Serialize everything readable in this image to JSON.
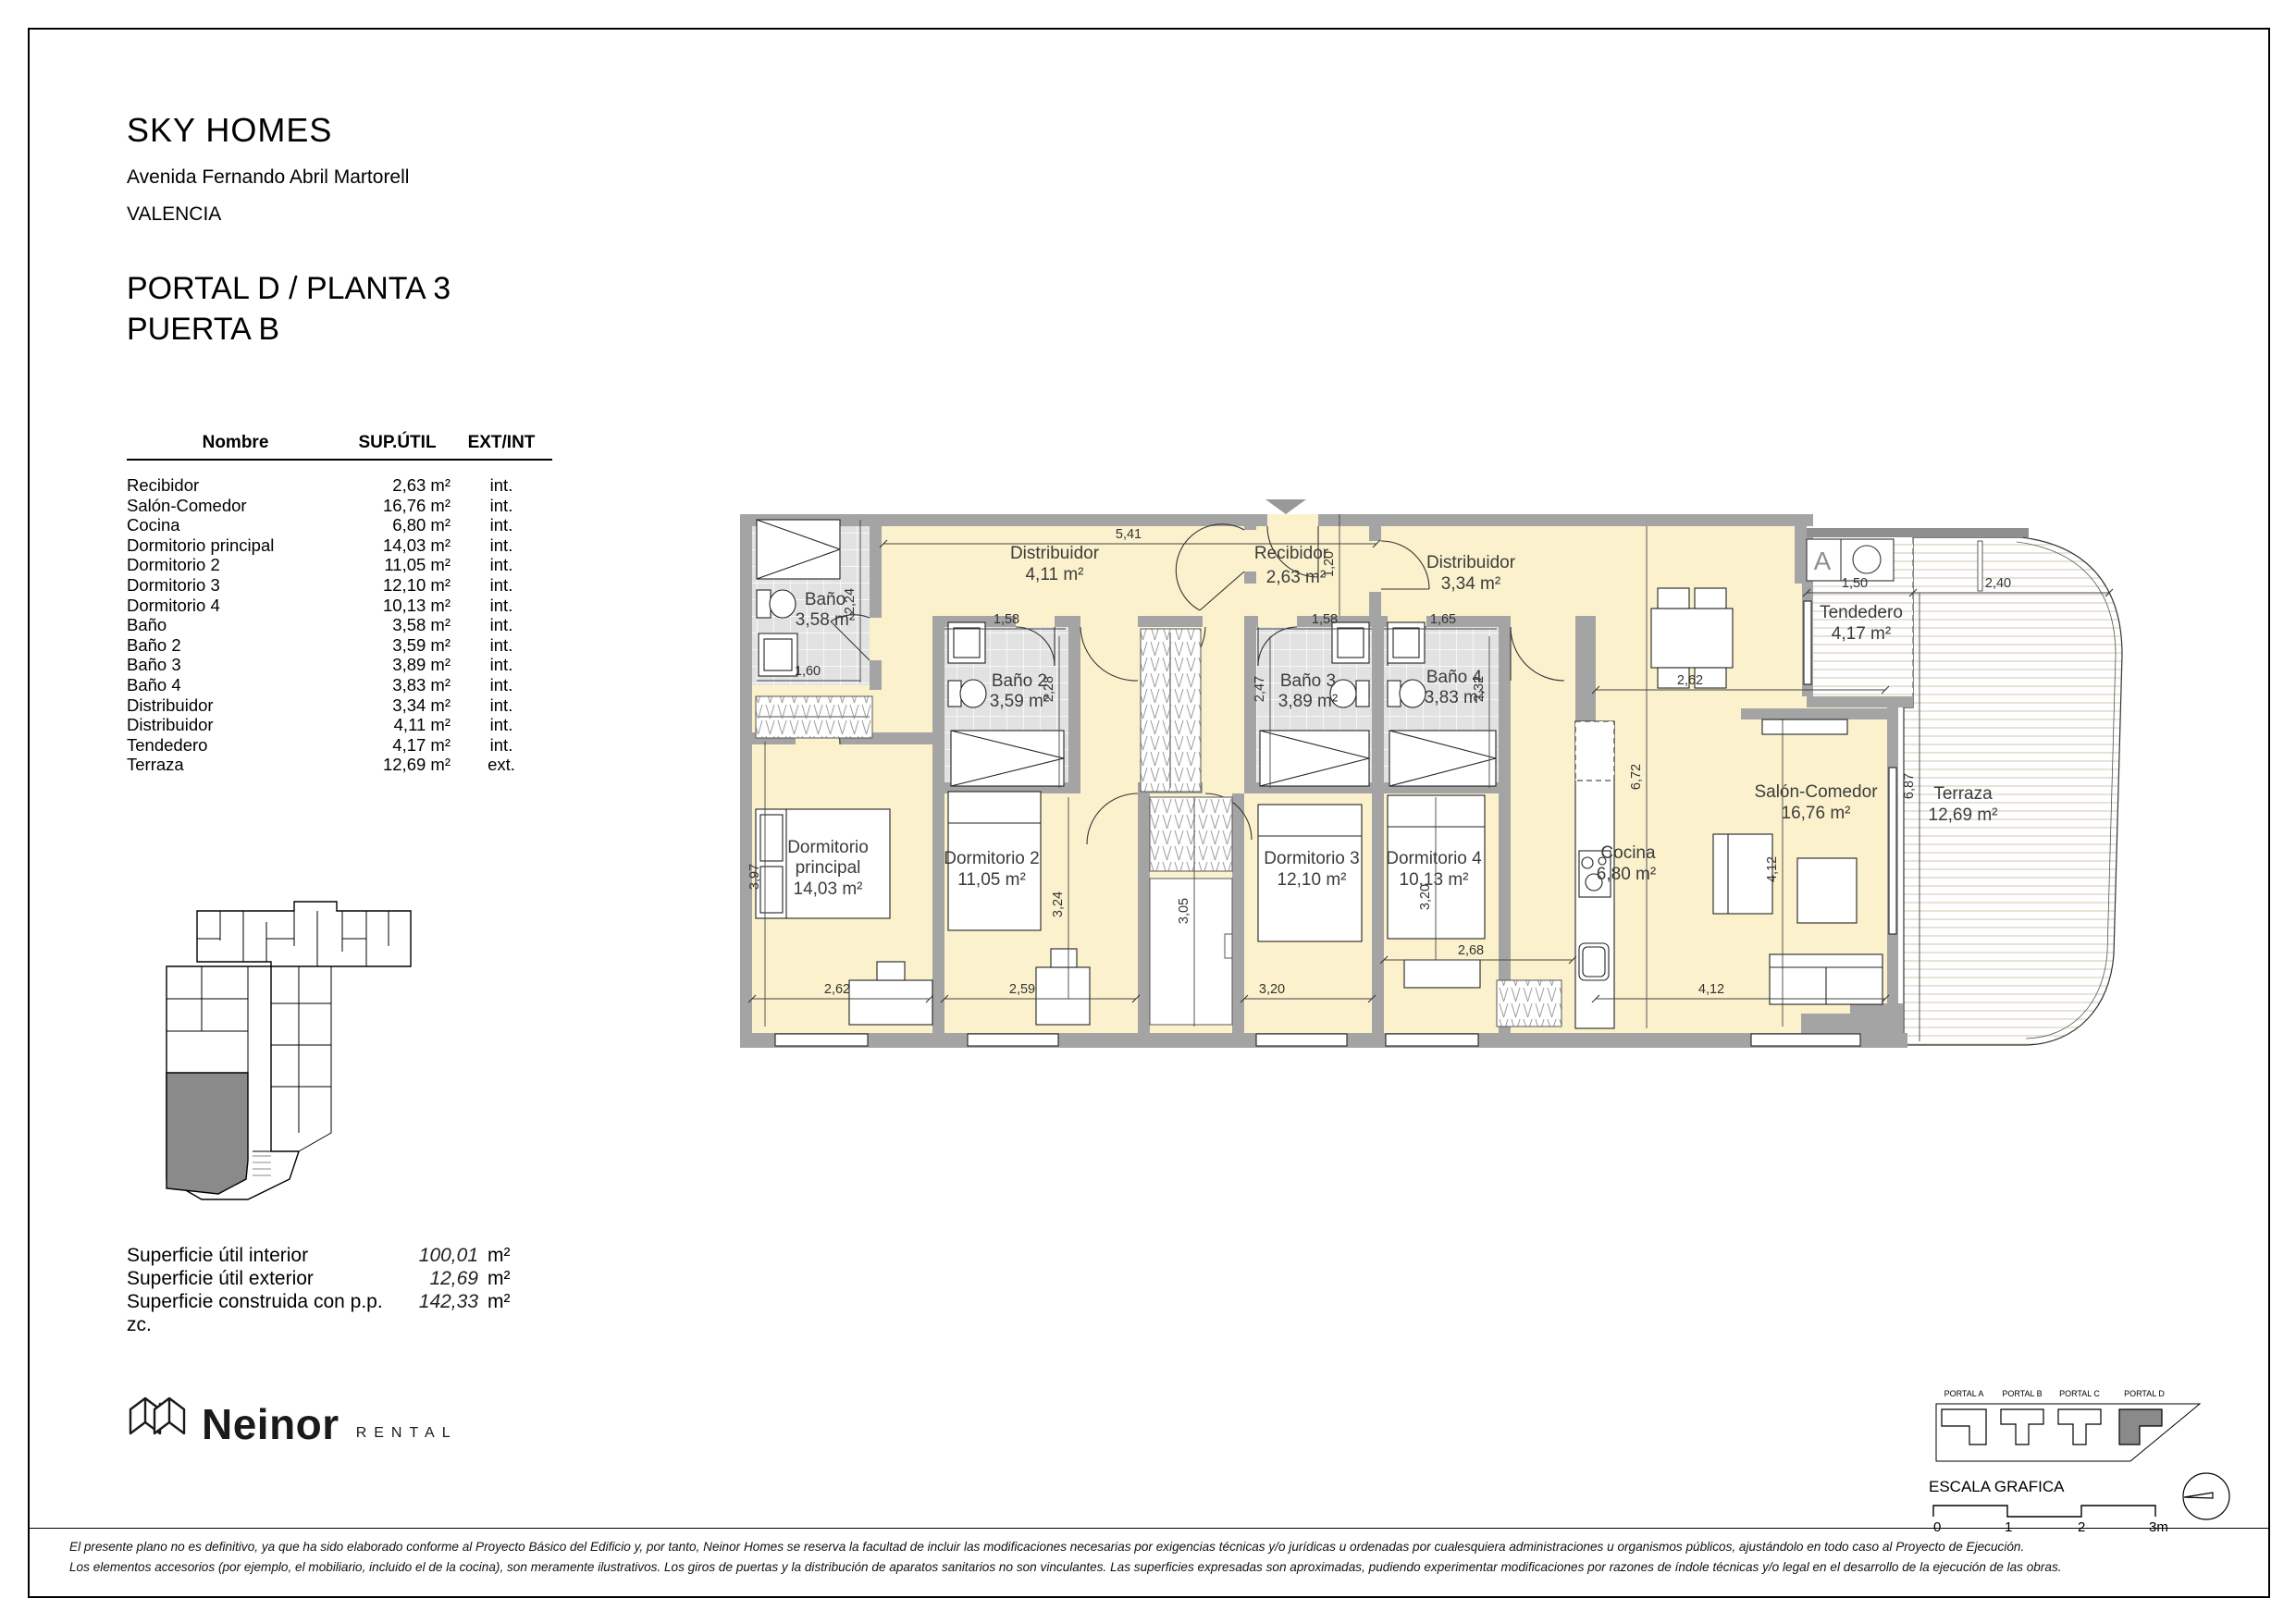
{
  "document": {
    "title": "SKY HOMES",
    "address": "Avenida Fernando Abril Martorell",
    "city": "VALENCIA",
    "unit_line1": "PORTAL D / PLANTA 3",
    "unit_line2": "PUERTA B"
  },
  "table": {
    "col_name": "Nombre",
    "col_area": "SUP.ÚTIL",
    "col_type": "EXT/INT",
    "rows": [
      {
        "name": "Recibidor",
        "area": "2,63 m²",
        "type": "int."
      },
      {
        "name": "Salón-Comedor",
        "area": "16,76 m²",
        "type": "int."
      },
      {
        "name": "Cocina",
        "area": "6,80 m²",
        "type": "int."
      },
      {
        "name": "Dormitorio principal",
        "area": "14,03 m²",
        "type": "int."
      },
      {
        "name": "Dormitorio 2",
        "area": "11,05 m²",
        "type": "int."
      },
      {
        "name": "Dormitorio 3",
        "area": "12,10 m²",
        "type": "int."
      },
      {
        "name": "Dormitorio 4",
        "area": "10,13 m²",
        "type": "int."
      },
      {
        "name": "Baño",
        "area": "3,58 m²",
        "type": "int."
      },
      {
        "name": "Baño 2",
        "area": "3,59 m²",
        "type": "int."
      },
      {
        "name": "Baño 3",
        "area": "3,89 m²",
        "type": "int."
      },
      {
        "name": "Baño 4",
        "area": "3,83 m²",
        "type": "int."
      },
      {
        "name": "Distribuidor",
        "area": "3,34 m²",
        "type": "int."
      },
      {
        "name": "Distribuidor",
        "area": "4,11 m²",
        "type": "int."
      },
      {
        "name": "Tendedero",
        "area": "4,17 m²",
        "type": "int."
      },
      {
        "name": "Terraza",
        "area": "12,69 m²",
        "type": "ext."
      }
    ]
  },
  "summary": {
    "rows": [
      {
        "label": "Superficie útil interior",
        "value": "100,01",
        "unit": "m²"
      },
      {
        "label": "Superficie útil exterior",
        "value": "12,69",
        "unit": "m²"
      },
      {
        "label": "Superficie construida con p.p. zc.",
        "value": "142,33",
        "unit": "m²"
      }
    ]
  },
  "plan": {
    "rooms": {
      "distribuidor1": {
        "name": "Distribuidor",
        "area": "4,11 m²"
      },
      "recibidor": {
        "name": "Recibidor",
        "area": "2,63 m²"
      },
      "distribuidor2": {
        "name": "Distribuidor",
        "area": "3,34 m²"
      },
      "bano1": {
        "name": "Baño",
        "area": "3,58 m²"
      },
      "bano2": {
        "name": "Baño 2",
        "area": "3,59 m²"
      },
      "bano3": {
        "name": "Baño 3",
        "area": "3,89 m²"
      },
      "bano4": {
        "name": "Baño 4",
        "area": "3,83 m²"
      },
      "dorm_principal": {
        "name": "Dormitorio",
        "name2": "principal",
        "area": "14,03 m²"
      },
      "dorm2": {
        "name": "Dormitorio 2",
        "area": "11,05 m²"
      },
      "dorm3": {
        "name": "Dormitorio 3",
        "area": "12,10 m²"
      },
      "dorm4": {
        "name": "Dormitorio 4",
        "area": "10,13 m²"
      },
      "cocina": {
        "name": "Cocina",
        "area": "6,80 m²"
      },
      "salon": {
        "name": "Salón-Comedor",
        "area": "16,76 m²"
      },
      "tendedero": {
        "name": "Tendedero",
        "area": "4,17 m²"
      },
      "terraza": {
        "name": "Terraza",
        "area": "12,69 m²"
      },
      "stair": {
        "label": "A"
      }
    },
    "dims": {
      "d541": "5,41",
      "d120": "1,20",
      "d224": "2,24",
      "d160": "1,60",
      "d158a": "1,58",
      "d228": "2,28",
      "d158b": "1,58",
      "d247": "2,47",
      "d165": "1,65",
      "d232": "2,32",
      "d397": "3,97",
      "d262a": "2,62",
      "d259": "2,59",
      "d324": "3,24",
      "d305": "3,05",
      "d320a": "3,20",
      "d268": "2,68",
      "d320b": "3,20",
      "d412a": "4,12",
      "d412b": "4,12",
      "d672": "6,72",
      "d262b": "2,62",
      "d150": "1,50",
      "d240": "2,40",
      "d687": "6,87"
    }
  },
  "brand": {
    "name": "Neinor",
    "division": "RENTAL"
  },
  "legend": {
    "portals": [
      "PORTAL A",
      "PORTAL B",
      "PORTAL C",
      "PORTAL D"
    ],
    "scale_label": "ESCALA GRAFICA",
    "ticks": [
      "0",
      "1",
      "2",
      "3m"
    ]
  },
  "footer": {
    "line1": "El presente plano no es definitivo, ya que ha sido elaborado conforme al Proyecto Básico del Edificio y, por tanto, Neinor Homes se reserva la facultad de incluir las modificaciones necesarias por exigencias técnicas y/o jurídicas u ordenadas por cualesquiera administraciones u organismos públicos, ajustándolo en todo caso al Proyecto de Ejecución.",
    "line2": "Los elementos accesorios (por ejemplo, el mobiliario, incluido el de la cocina), son meramente ilustrativos. Los giros de puertas y la distribución de aparatos sanitarios no son vinculantes. Las superficies expresadas son aproximadas, pudiendo experimentar modificaciones por razones de índole técnicas y/o legal en el desarrollo de la ejecución de las obras."
  }
}
